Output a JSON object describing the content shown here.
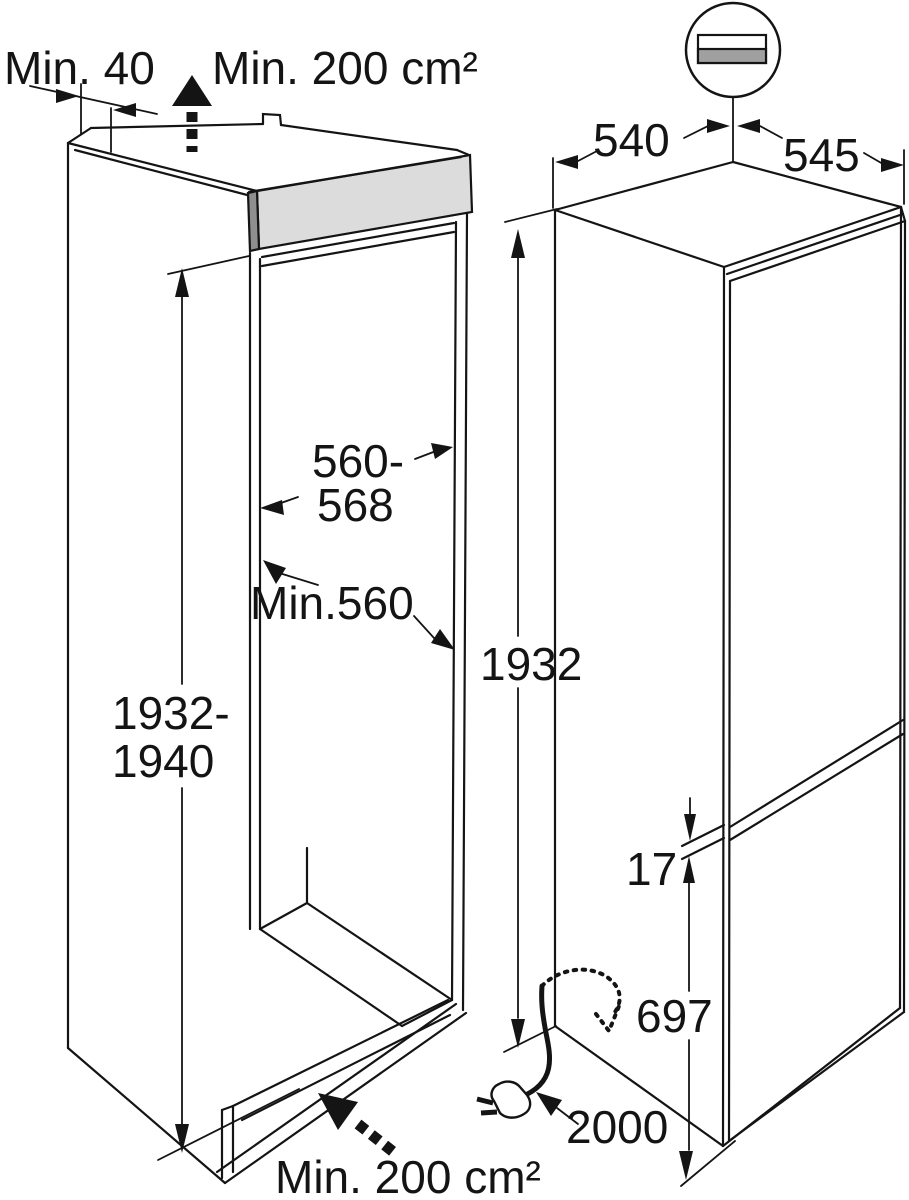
{
  "diagram_title": "built-in fridge-freezer installation dimensions diagram",
  "colors": {
    "line": "#141414",
    "background": "#ffffff",
    "grille_front": "#dcdcdc",
    "grille_end": "#8f8f8f",
    "detail_bar": "#a0a0a0"
  },
  "niche": {
    "wall_clearance": "Min. 40",
    "top_ventilation": "Min. 200 cm²",
    "width_line1": "560-",
    "width_line2": "568",
    "depth": "Min.560",
    "height_line1": "1932-",
    "height_line2": "1940",
    "bottom_ventilation": "Min. 200 cm²"
  },
  "appliance": {
    "width": "540",
    "depth": "545",
    "height": "1932",
    "door_gap": "17",
    "freezer_door_height": "697",
    "power_cord_length": "2000"
  }
}
